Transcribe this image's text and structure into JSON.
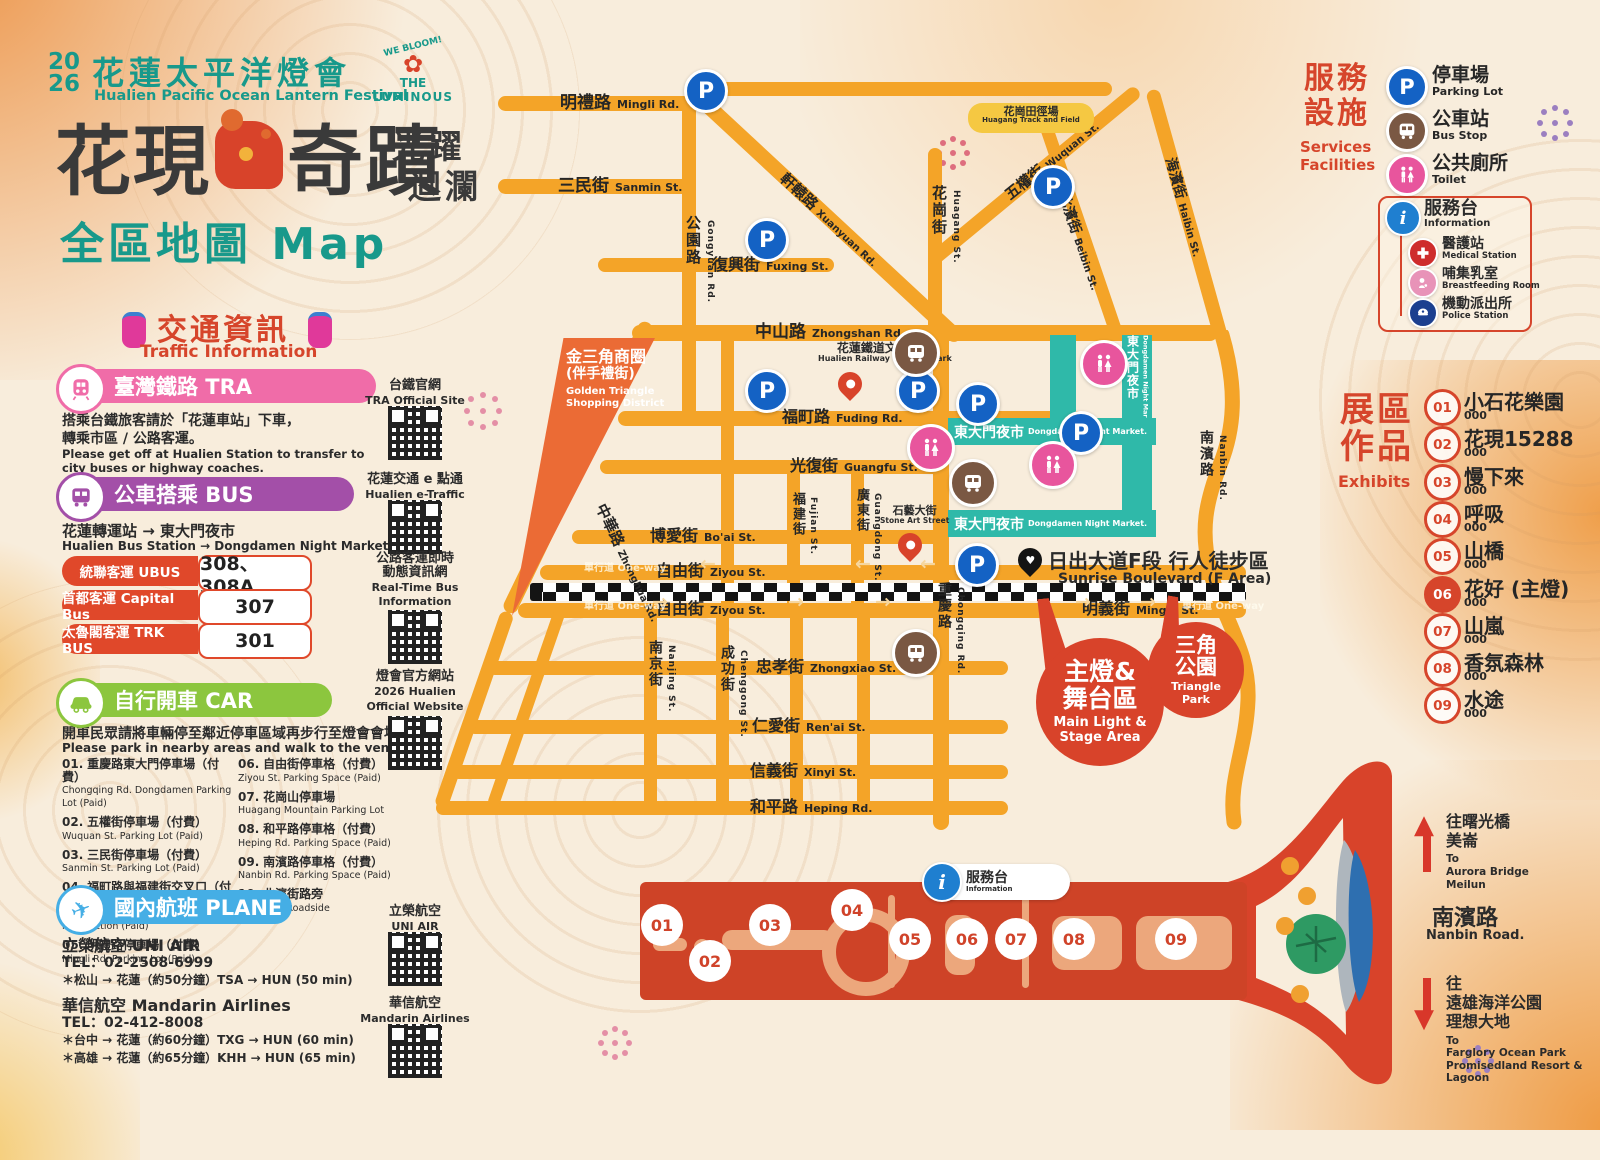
{
  "colors": {
    "background": "#F8EDDC",
    "road_orange": "#F4A428",
    "deep_orange": "#EB6B35",
    "teal_brand": "#18998B",
    "accent_red": "#D6452B",
    "strip_red": "#CE4327",
    "night_market_teal": "#2FB9A9",
    "parking_blue": "#1462C4",
    "bus_brown": "#7A5843",
    "toilet_pink": "#E8559D",
    "tra_pink": "#F06CA8",
    "bus_purple": "#A34FA8",
    "car_green": "#8CC63E",
    "plane_blue": "#45AEE5",
    "police_navy": "#1B3F8F"
  },
  "icons": {
    "parking": "P",
    "info": "i",
    "plane": "✈",
    "heart": "♥",
    "flower": "✿",
    "arrow_left": "←",
    "arrow_right": "→",
    "up_arrow": "▲",
    "down_arrow": "▼"
  },
  "header": {
    "year_top": "20",
    "year_bottom": "26",
    "festival_zh": "花蓮太平洋燈會",
    "festival_en": "Hualien Pacific Ocean Lantern Festival",
    "logo_arc": "WE BLOOM!",
    "logo_line1": "THE",
    "logo_line2": "LUMINOUS",
    "slogan_left": "花現",
    "slogan_right": "奇蹟",
    "slogan_side1": "光躍",
    "slogan_side2": "迴瀾",
    "map_title_zh": "全區地圖",
    "map_title_en": "Map"
  },
  "traffic": {
    "title_zh": "交通資訊",
    "title_en": "Traffic Information",
    "tra": {
      "badge": "臺灣鐵路 TRA",
      "body_zh1": "搭乘台鐵旅客請於「花蓮車站」下車，",
      "body_zh2": "轉乘市區 / 公路客運。",
      "body_en1": "Please get off at Hualien Station to transfer to",
      "body_en2": "city buses or highway coaches."
    },
    "bus": {
      "badge": "公車搭乘 BUS",
      "route_zh": "花蓮轉運站 → 東大門夜市",
      "route_en": "Hualien Bus Station → Dongdamen Night Market",
      "rows": [
        {
          "label": "統聯客運 UBUS",
          "value": "308、308A"
        },
        {
          "label": "首都客運 Capital Bus",
          "value": "307"
        },
        {
          "label": "太魯閣客運 TRK BUS",
          "value": "301"
        }
      ]
    },
    "car": {
      "badge": "自行開車 CAR",
      "note_zh": "開車民眾請將車輛停至鄰近停車區域再步行至燈會會場",
      "note_en": "Please park in nearby areas and walk to the venue.",
      "parking": [
        {
          "num": "01.",
          "zh": "重慶路東大門停車場（付費）",
          "en": "Chongqing Rd. Dongdamen Parking Lot (Paid)"
        },
        {
          "num": "02.",
          "zh": "五權街停車場（付費）",
          "en": "Wuquan St. Parking Lot (Paid)"
        },
        {
          "num": "03.",
          "zh": "三民街停車場（付費）",
          "en": "Sanmin St. Parking Lot (Paid)"
        },
        {
          "num": "04.",
          "zh": "福町路與福建街交叉口（付費）",
          "en": "Fuching Rd.&Fuchien St. intersection (Paid)"
        },
        {
          "num": "05.",
          "zh": "明禮路停車場（付費）",
          "en": "Mingli Rd. Parking Lot (Paid)"
        },
        {
          "num": "06.",
          "zh": "自由街停車格（付費）",
          "en": "Ziyou St. Parking Space (Paid)"
        },
        {
          "num": "07.",
          "zh": "花崗山停車場",
          "en": "Huagang Mountain Parking Lot"
        },
        {
          "num": "08.",
          "zh": "和平路停車格（付費）",
          "en": "Heping Rd. Parking Space (Paid)"
        },
        {
          "num": "09.",
          "zh": "南濱路停車格（付費）",
          "en": "Nanbin Rd. Parking Space (Paid)"
        },
        {
          "num": "10.",
          "zh": "北濱街路旁",
          "en": "Beibin St. Roadside"
        }
      ]
    },
    "plane": {
      "badge": "國內航班 PLANE",
      "airlines": [
        {
          "name": "立榮航空 UNI AIR",
          "tel": "TEL：02-2508-6999",
          "r1": "＊松山 → 花蓮（約50分鐘）TSA → HUN (50 min)",
          "r2": ""
        },
        {
          "name": "華信航空 Mandarin Airlines",
          "tel": "TEL：02-412-8008",
          "r1": "＊台中 → 花蓮（約60分鐘）TXG → HUN (60 min)",
          "r2": "＊高雄 → 花蓮（約65分鐘）KHH → HUN (65 min)"
        }
      ]
    }
  },
  "qr_links": [
    {
      "zh": "台鐵官網",
      "zh2": "",
      "en": "TRA Official Site",
      "en2": ""
    },
    {
      "zh": "花蓮交通 e 點通",
      "zh2": "",
      "en": "Hualien e-Traffic",
      "en2": ""
    },
    {
      "zh": "公路客運即時",
      "zh2": "動態資訊網",
      "en": "Real-Time Bus",
      "en2": "Information"
    },
    {
      "zh": "燈會官方網站",
      "zh2": "",
      "en": "2026 Hualien",
      "en2": "Official Website"
    },
    {
      "zh": "立榮航空",
      "zh2": "",
      "en": "UNI AIR",
      "en2": ""
    },
    {
      "zh": "華信航空",
      "zh2": "",
      "en": "Mandarin Airlines",
      "en2": ""
    }
  ],
  "services": {
    "title_zh1": "服務",
    "title_zh2": "設施",
    "title_en1": "Services",
    "title_en2": "Facilities",
    "items": [
      {
        "zh": "停車場",
        "en": "Parking Lot",
        "icon": "parking"
      },
      {
        "zh": "公車站",
        "en": "Bus Stop",
        "icon": "bus"
      },
      {
        "zh": "公共廁所",
        "en": "Toilet",
        "icon": "toilet"
      }
    ],
    "info_box": [
      {
        "zh": "服務台",
        "en": "Information",
        "icon": "info"
      },
      {
        "zh": "醫護站",
        "en": "Medical Station",
        "icon": "medical"
      },
      {
        "zh": "哺集乳室",
        "en": "Breastfeeding Room",
        "icon": "breastfeeding"
      },
      {
        "zh": "機動派出所",
        "en": "Police Station",
        "icon": "police"
      }
    ]
  },
  "exhibits": {
    "title_zh1": "展區",
    "title_zh2": "作品",
    "title_en": "Exhibits",
    "items": [
      {
        "num": "01",
        "name": "小石花樂園",
        "sub": "000"
      },
      {
        "num": "02",
        "name": "花現15288",
        "sub": "000"
      },
      {
        "num": "03",
        "name": "慢下來",
        "sub": "000"
      },
      {
        "num": "04",
        "name": "呼吸",
        "sub": "000"
      },
      {
        "num": "05",
        "name": "山橋",
        "sub": "000"
      },
      {
        "num": "06",
        "name": "花好 (主燈)",
        "sub": "000"
      },
      {
        "num": "07",
        "name": "山嵐",
        "sub": "000"
      },
      {
        "num": "08",
        "name": "香氛森林",
        "sub": "000"
      },
      {
        "num": "09",
        "name": "水途",
        "sub": "000"
      }
    ]
  },
  "map": {
    "oneway": {
      "zh": "單行道",
      "en": "One-way"
    },
    "roads": {
      "mingli": {
        "zh": "明禮路",
        "en": "Mingli Rd."
      },
      "sanmin": {
        "zh": "三民街",
        "en": "Sanmin St."
      },
      "fuxing": {
        "zh": "復興街",
        "en": "Fuxing St."
      },
      "zhongshan": {
        "zh": "中山路",
        "en": "Zhongshan Rd."
      },
      "fuding": {
        "zh": "福町路",
        "en": "Fuding Rd."
      },
      "guangfu": {
        "zh": "光復街",
        "en": "Guangfu St."
      },
      "boai": {
        "zh": "博愛街",
        "en": "Bo'ai St."
      },
      "ziyou": {
        "zh": "自由街",
        "en": "Ziyou St."
      },
      "mingyi": {
        "zh": "明義街",
        "en": "Mingyi St."
      },
      "zhongxiao": {
        "zh": "忠孝街",
        "en": "Zhongxiao St."
      },
      "renai": {
        "zh": "仁愛街",
        "en": "Ren'ai St."
      },
      "xinyi": {
        "zh": "信義街",
        "en": "Xinyi St."
      },
      "heping": {
        "zh": "和平路",
        "en": "Heping Rd."
      },
      "gongyuan": {
        "zh": "公園路",
        "en": "Gongyuan Rd."
      },
      "xuanyuan": {
        "zh": "軒轅路",
        "en": "Xuanyuan Rd."
      },
      "huagang": {
        "zh": "花崗街",
        "en": "Huagang St."
      },
      "wuquan": {
        "zh": "五權街",
        "en": "Wuquan St."
      },
      "beibin": {
        "zh": "北濱街",
        "en": "Beibin St."
      },
      "haibin": {
        "zh": "海濱街",
        "en": "Haibin St."
      },
      "nanbin": {
        "zh": "南濱路",
        "en": "Nanbin Rd."
      },
      "zhonghua": {
        "zh": "中華路",
        "en": "Zhonghua Rd."
      },
      "fujian": {
        "zh": "福建街",
        "en": "Fujian St."
      },
      "guangdong": {
        "zh": "廣東街",
        "en": "Guangdong St."
      },
      "chongqing": {
        "zh": "重慶路",
        "en": "Chongqing Rd."
      },
      "nanjing": {
        "zh": "南京街",
        "en": "Nanjing St."
      },
      "chenggong": {
        "zh": "成功街",
        "en": "Chenggong St."
      }
    },
    "places": {
      "golden_triangle": {
        "zh1": "金三角商圈",
        "zh2": "(伴手禮街)",
        "en1": "Golden Triangle",
        "en2": "Shopping District"
      },
      "track_field": {
        "zh": "花崗田徑場",
        "en": "Huagang Track and Field"
      },
      "railway_park": {
        "zh": "花蓮鐵道文化園區",
        "en": "Hualien Railway Cultural Park"
      },
      "stone_art": {
        "zh": "石藝大街",
        "en": "Stone Art Street"
      },
      "night_market": {
        "zh": "東大門夜市",
        "en": "Dongdamen Night Market."
      },
      "sunrise": {
        "zh": "日出大道F段 行人徒步區",
        "en": "Sunrise Boulevard (F Area)"
      },
      "callout_main": {
        "zh1": "主燈&",
        "zh2": "舞台區",
        "en1": "Main Light &",
        "en2": "Stage Area"
      },
      "callout_park": {
        "zh1": "三角",
        "zh2": "公園",
        "en1": "Triangle",
        "en2": "Park"
      }
    }
  },
  "directions": {
    "aurora": {
      "zh1": "往曙光橋",
      "zh2": "美崙",
      "en1": "To",
      "en2": "Aurora Bridge",
      "en3": "Meilun"
    },
    "nanbin_road": {
      "zh": "南濱路",
      "en": "Nanbin Road."
    },
    "farglory": {
      "zh1": "往",
      "zh2": "遠雄海洋公園",
      "zh3": "理想大地",
      "en1": "To",
      "en2": "Farglory Ocean Park",
      "en3": "Promisedland Resort & Lagoon"
    }
  },
  "bottom_strip": {
    "info_zh": "服務台",
    "info_en": "Information",
    "numbers": [
      "01",
      "02",
      "03",
      "04",
      "05",
      "06",
      "07",
      "08",
      "09"
    ]
  }
}
